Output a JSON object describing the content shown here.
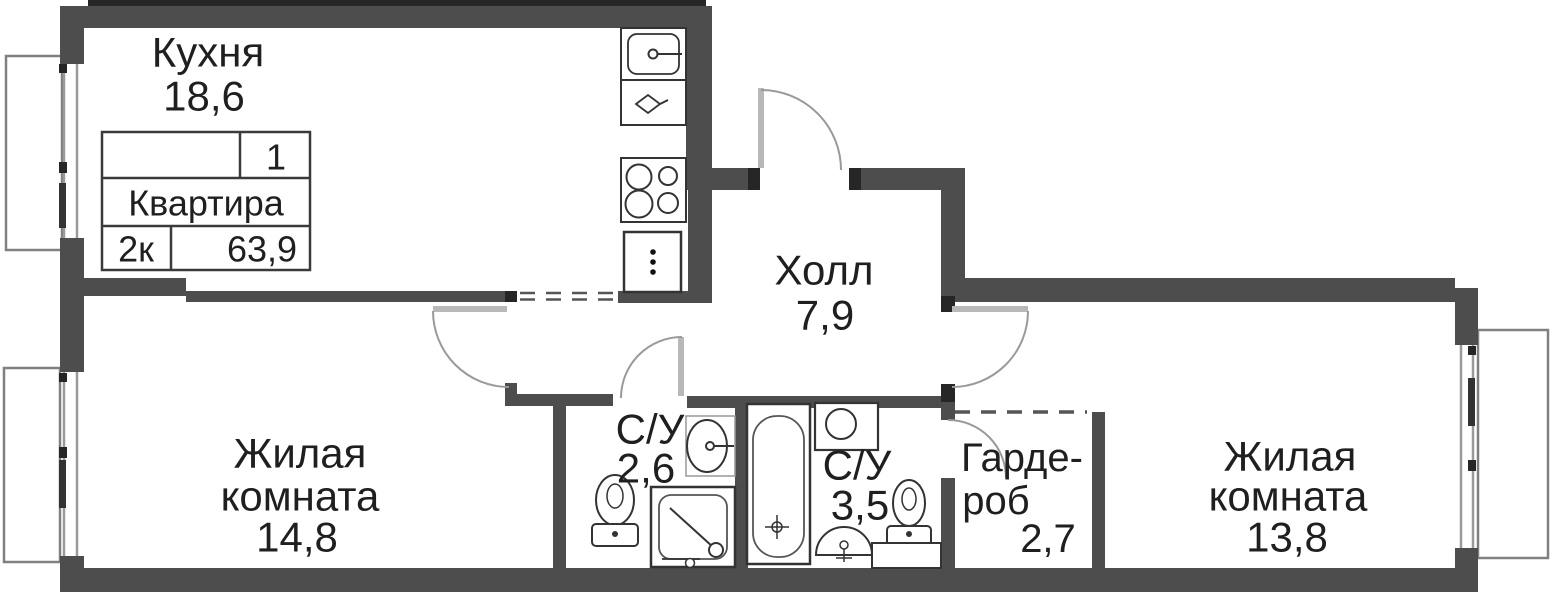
{
  "plan_title": "2-room apartment floor plan",
  "rooms": {
    "kitchen": {
      "name": "Кухня",
      "area": "18,6"
    },
    "hall": {
      "name": "Холл",
      "area": "7,9"
    },
    "living1": {
      "line1": "Жилая",
      "line2": "комната",
      "area": "14,8"
    },
    "living2": {
      "line1": "Жилая",
      "line2": "комната",
      "area": "13,8"
    },
    "bath1": {
      "name": "С/У",
      "area": "2,6"
    },
    "bath2": {
      "name": "С/У",
      "area": "3,5"
    },
    "wardrobe": {
      "line1": "Гарде-",
      "line2": "роб",
      "area": "2,7"
    }
  },
  "info_table": {
    "position": "1",
    "label": "Квартира",
    "rooms_count": "2к",
    "total_area": "63,9"
  },
  "colors": {
    "wall": "#4d4d4d",
    "wall_dark": "#262626",
    "fixture_line": "#333333",
    "door_arc": "#9a9a9a",
    "door_leaf": "#b8b8b8",
    "text": "#1f1f1f"
  }
}
